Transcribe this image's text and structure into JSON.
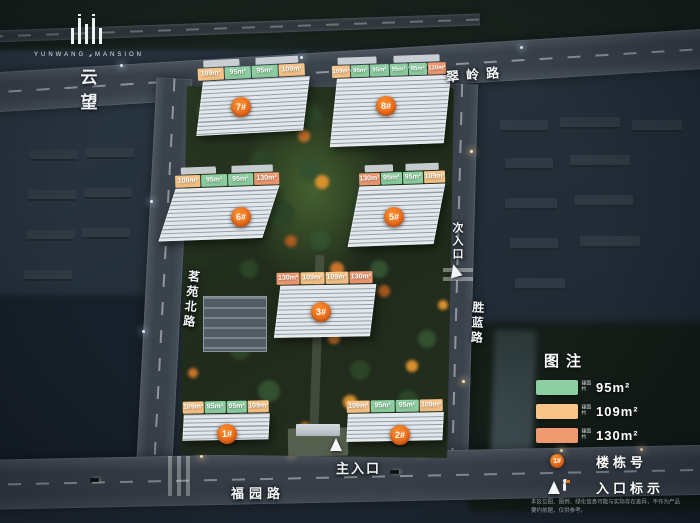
{
  "logo": {
    "brand_en_left": "YUNWANG",
    "brand_en_right": "MANSION",
    "brand_cn": "云 望"
  },
  "roads": {
    "top": {
      "label": "翠岭路"
    },
    "left": {
      "label": "茗苑北路"
    },
    "right": {
      "label": "胜蓝路"
    },
    "bottom": {
      "label": "福园路"
    }
  },
  "entrances": {
    "secondary": {
      "label": "次入口"
    },
    "main": {
      "label": "主入口"
    }
  },
  "area_colors": {
    "95": "#8ecfa2",
    "109": "#f8c488",
    "130": "#f09a72"
  },
  "buildings": [
    {
      "number": "7#",
      "areas": [
        {
          "label": "109m²",
          "type": "109"
        },
        {
          "label": "95m²",
          "type": "95"
        },
        {
          "label": "95m²",
          "type": "95"
        },
        {
          "label": "109m²",
          "type": "109"
        }
      ]
    },
    {
      "number": "8#",
      "areas": [
        {
          "label": "109m²",
          "type": "109"
        },
        {
          "label": "95m²",
          "type": "95"
        },
        {
          "label": "95m²",
          "type": "95"
        },
        {
          "label": "95m²",
          "type": "95"
        },
        {
          "label": "95m²",
          "type": "95"
        },
        {
          "label": "130m²",
          "type": "130"
        }
      ]
    },
    {
      "number": "6#",
      "areas": [
        {
          "label": "109m²",
          "type": "109"
        },
        {
          "label": "95m²",
          "type": "95"
        },
        {
          "label": "95m²",
          "type": "95"
        },
        {
          "label": "130m²",
          "type": "130"
        }
      ]
    },
    {
      "number": "5#",
      "areas": [
        {
          "label": "130m²",
          "type": "130"
        },
        {
          "label": "95m²",
          "type": "95"
        },
        {
          "label": "95m²",
          "type": "95"
        },
        {
          "label": "109m²",
          "type": "109"
        }
      ]
    },
    {
      "number": "3#",
      "areas": [
        {
          "label": "130m²",
          "type": "130"
        },
        {
          "label": "109m²",
          "type": "109"
        },
        {
          "label": "109m²",
          "type": "109"
        },
        {
          "label": "130m²",
          "type": "130"
        }
      ]
    },
    {
      "number": "1#",
      "areas": [
        {
          "label": "109m²",
          "type": "109"
        },
        {
          "label": "95m²",
          "type": "95"
        },
        {
          "label": "95m²",
          "type": "95"
        },
        {
          "label": "109m²",
          "type": "109"
        }
      ]
    },
    {
      "number": "2#",
      "areas": [
        {
          "label": "109m²",
          "type": "109"
        },
        {
          "label": "95m²",
          "type": "95"
        },
        {
          "label": "95m²",
          "type": "95"
        },
        {
          "label": "109m²",
          "type": "109"
        }
      ]
    }
  ],
  "legend": {
    "title": "图注",
    "items": [
      {
        "color": "#8ecfa2",
        "prefix": "建面约",
        "label": "95m²"
      },
      {
        "color": "#f8c488",
        "prefix": "建面约",
        "label": "109m²"
      },
      {
        "color": "#f09a72",
        "prefix": "建面约",
        "label": "130m²"
      }
    ],
    "building_row": {
      "badge": "1#",
      "label": "楼栋号"
    },
    "entrance_row": {
      "label": "入口标示"
    }
  },
  "disclaimer": "本区位图、图例、绿化信息可能与实际存在差异，不作为产品要约依据，仅供参考。"
}
